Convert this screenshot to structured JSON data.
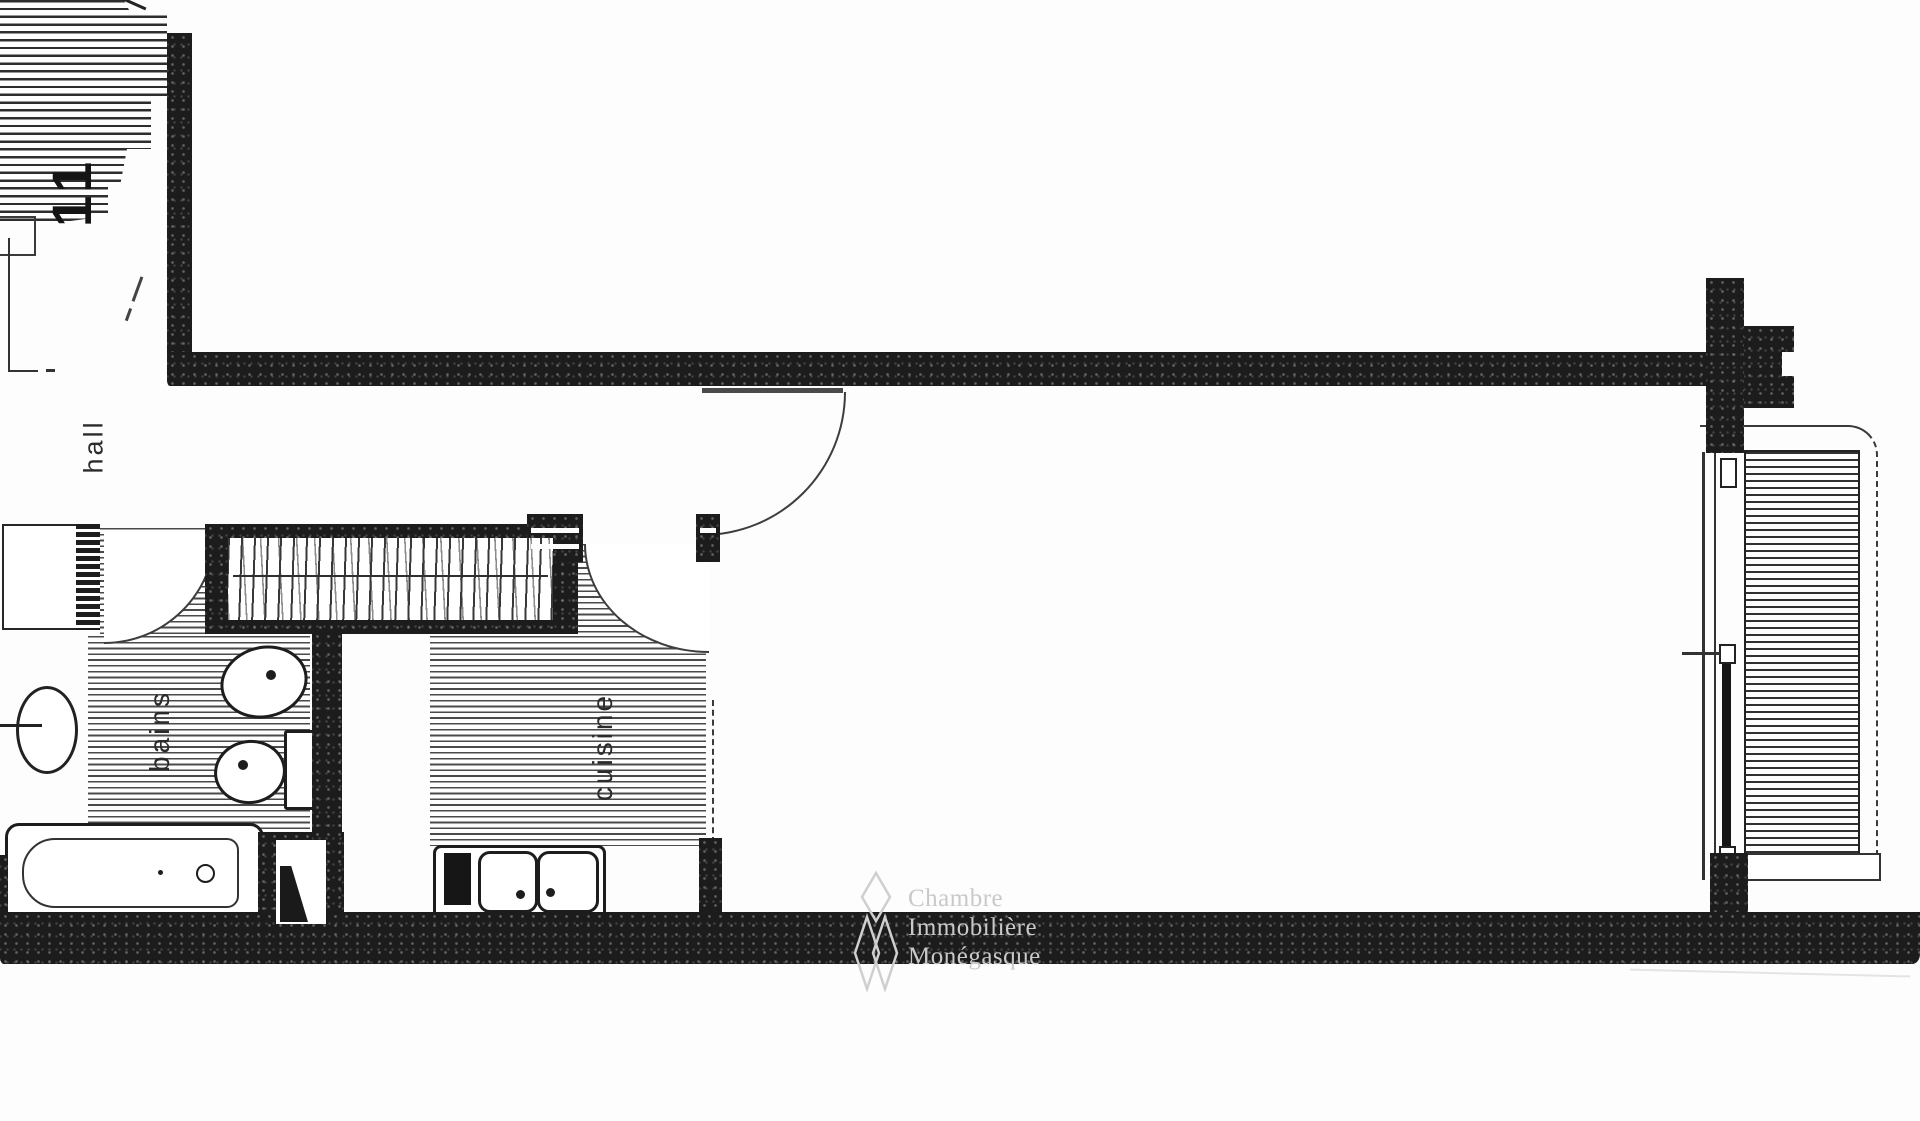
{
  "plan": {
    "labels": {
      "stair_number": "11",
      "hall": "hall",
      "bathroom": "bains",
      "kitchen": "cuisine"
    },
    "watermark": {
      "line1": "Chambre",
      "line2": "Immobilière",
      "line3": "Monégasque"
    },
    "colors": {
      "ink": "#1c1c1c",
      "paper": "#fdfdfd",
      "hatch": "#3c3c3c",
      "watermark_gray": "#c9c9c9"
    }
  }
}
